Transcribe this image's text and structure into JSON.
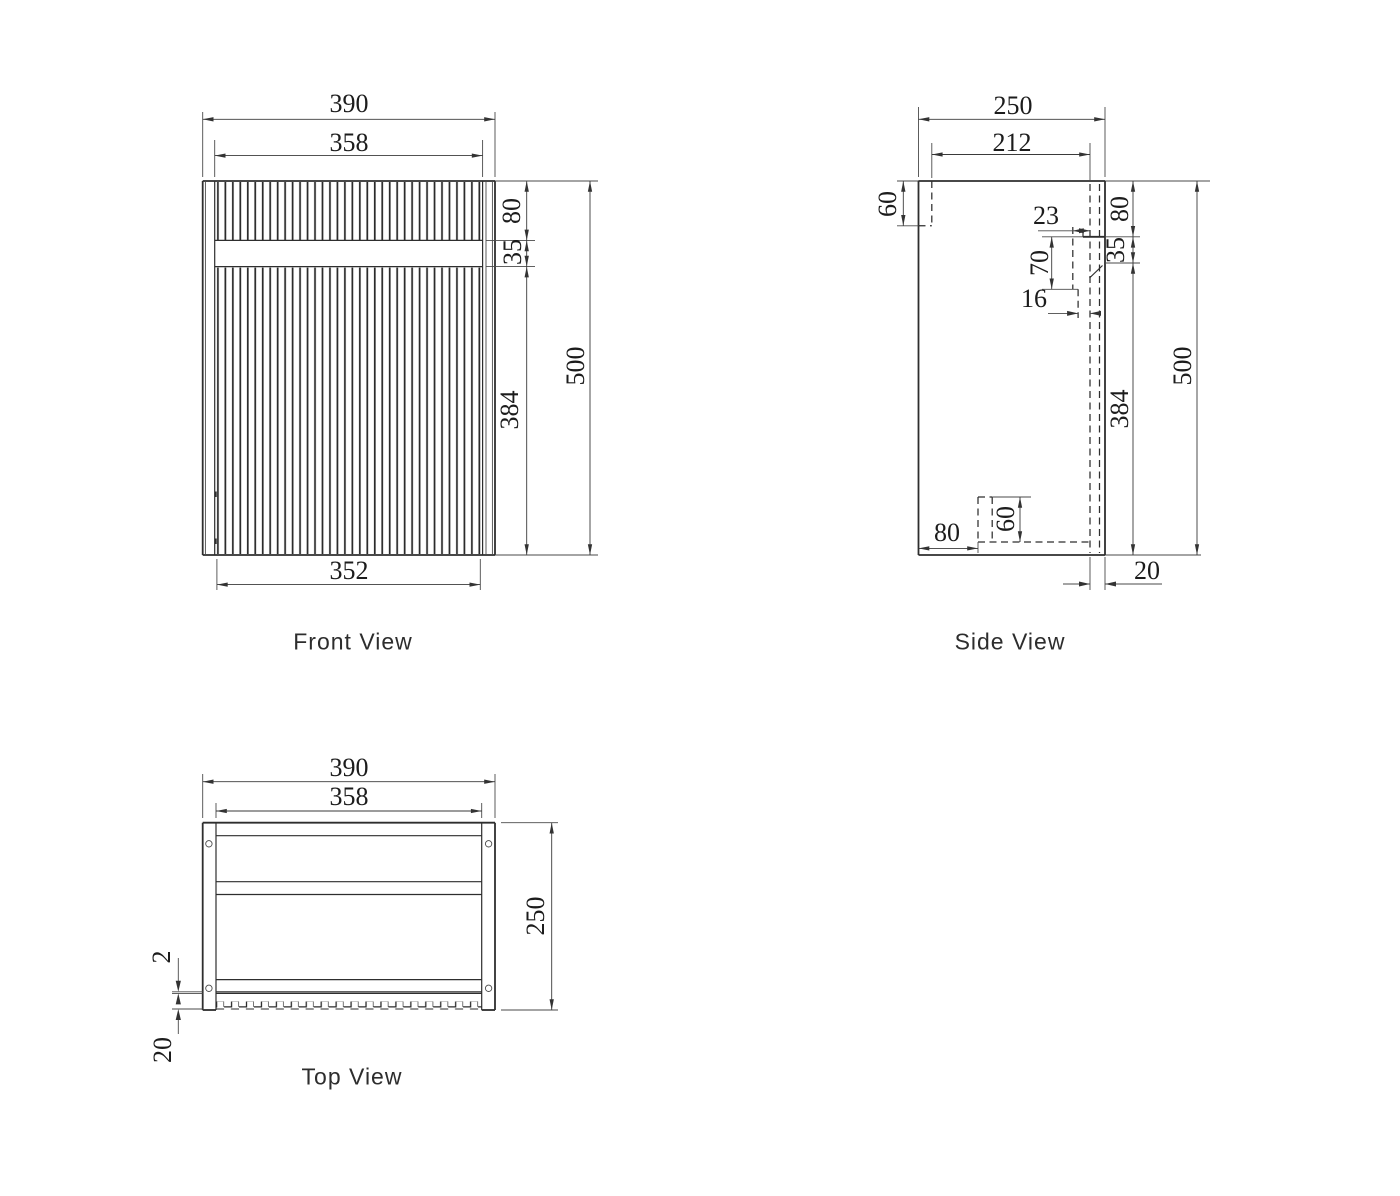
{
  "drawing": {
    "front": {
      "label": "Front View",
      "dims": {
        "overall_width": "390",
        "door_width": "358",
        "bottom_width": "352",
        "drawer_front_height": "80",
        "reveal_gap": "35",
        "door_height": "384",
        "overall_height": "500"
      }
    },
    "side": {
      "label": "Side View",
      "dims": {
        "overall_depth": "250",
        "internal_depth": "212",
        "top_rail_height": "60",
        "recess_depth": "23",
        "recess_height": "70",
        "recess_lip": "16",
        "drawer_front_height": "80",
        "reveal_gap": "35",
        "door_height": "384",
        "overall_height": "500",
        "bottom_rail_offset": "80",
        "bottom_rail_height": "60",
        "door_thickness": "20"
      }
    },
    "top": {
      "label": "Top View",
      "dims": {
        "overall_width": "390",
        "internal_width": "358",
        "overall_depth": "250",
        "door_gap": "2",
        "door_thickness": "20"
      }
    }
  }
}
